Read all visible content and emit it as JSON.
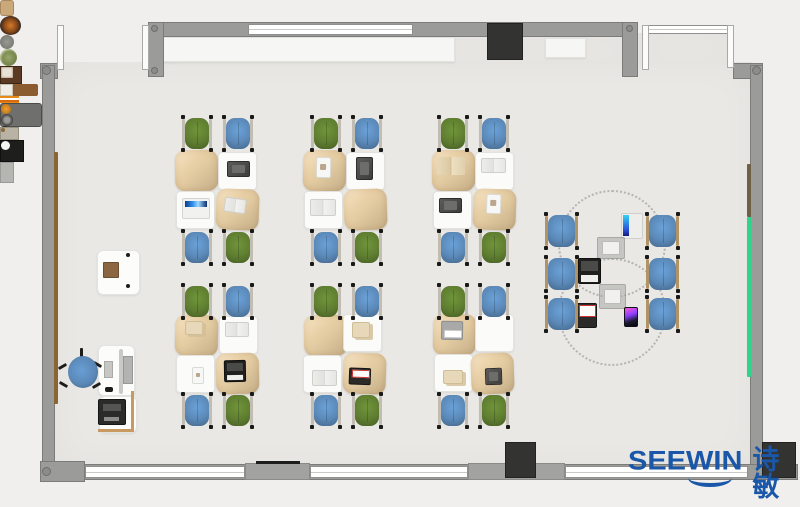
{
  "meta": {
    "description": "Top-down classroom / makerspace furniture floor plan render"
  },
  "logo": {
    "brand": "SEEWIN",
    "cjk": "诗敏",
    "color": "#1a57a8"
  },
  "palette": {
    "bg": "#f0efed",
    "floor": "#e9e8e5",
    "wall": "#9b9b99",
    "chair_green": "#5f7e31",
    "chair_blue": "#5b89b8",
    "desk_tan": "#e5cda4",
    "desk_white": "#fbfbf9",
    "frame_grey": "#c2bdb2",
    "frame_tan": "#b09465",
    "rail_brown_left": "#8a6432",
    "rail_brown_right": "#6f6148",
    "rail_green": "#2ed489",
    "dark_block": "#333332",
    "logo_blue": "#1a57a8"
  },
  "floorplan": {
    "floors": [
      {
        "x": 55,
        "y": 62,
        "w": 697,
        "h": 405
      },
      {
        "x": 163,
        "y": 35,
        "w": 474,
        "h": 30
      },
      {
        "x": 637,
        "y": 33,
        "w": 96,
        "h": 32
      }
    ],
    "walls": [
      {
        "x": 163,
        "y": 22,
        "w": 474,
        "h": 15
      },
      {
        "x": 40,
        "y": 63,
        "w": 18,
        "h": 16
      },
      {
        "x": 148,
        "y": 22,
        "w": 16,
        "h": 55
      },
      {
        "x": 622,
        "y": 22,
        "w": 16,
        "h": 55
      },
      {
        "x": 733,
        "y": 63,
        "w": 30,
        "h": 16
      },
      {
        "x": 42,
        "y": 65,
        "w": 13,
        "h": 412
      },
      {
        "x": 750,
        "y": 65,
        "w": 13,
        "h": 412
      },
      {
        "x": 40,
        "y": 464,
        "w": 758,
        "h": 16
      },
      {
        "x": 40,
        "y": 461,
        "w": 45,
        "h": 21
      }
    ],
    "piers": [
      {
        "x": 245,
        "y": 463,
        "w": 65,
        "h": 17
      },
      {
        "x": 468,
        "y": 463,
        "w": 97,
        "h": 17
      }
    ],
    "windows": [
      {
        "x": 248,
        "y": 24,
        "w": 165,
        "h": 11
      },
      {
        "x": 648,
        "y": 25,
        "w": 81,
        "h": 9
      },
      {
        "x": 85,
        "y": 466,
        "w": 160,
        "h": 12
      },
      {
        "x": 310,
        "y": 466,
        "w": 158,
        "h": 12
      },
      {
        "x": 565,
        "y": 466,
        "w": 183,
        "h": 12
      }
    ],
    "doors": [
      {
        "x": 57,
        "y": 25,
        "w": 7,
        "h": 45
      },
      {
        "x": 142,
        "y": 25,
        "w": 7,
        "h": 45
      },
      {
        "x": 642,
        "y": 25,
        "w": 7,
        "h": 45
      },
      {
        "x": 727,
        "y": 25,
        "w": 7,
        "h": 43
      }
    ],
    "dark_blocks": [
      {
        "x": 487,
        "y": 23,
        "w": 36,
        "h": 37,
        "name": "tv-screen"
      },
      {
        "x": 505,
        "y": 442,
        "w": 31,
        "h": 36,
        "name": "column-block"
      },
      {
        "x": 762,
        "y": 442,
        "w": 34,
        "h": 36,
        "name": "column-block"
      }
    ],
    "bench": {
      "x": 256,
      "y": 461,
      "w": 44,
      "h": 3
    },
    "rails": [
      {
        "x": 54,
        "y": 152,
        "w": 4,
        "h": 252,
        "color": "rail_brown_left",
        "name": "wall-rail-brown"
      },
      {
        "x": 747,
        "y": 164,
        "w": 4,
        "h": 53,
        "color": "rail_brown_right",
        "name": "wall-rail-brown"
      },
      {
        "x": 747,
        "y": 217,
        "w": 4,
        "h": 160,
        "color": "rail_green",
        "name": "whiteboard-rail-green"
      }
    ],
    "joints": [
      {
        "x": 42,
        "y": 66,
        "d": 9
      },
      {
        "x": 151,
        "y": 25,
        "d": 7
      },
      {
        "x": 151,
        "y": 67,
        "d": 7
      },
      {
        "x": 626,
        "y": 25,
        "d": 7
      },
      {
        "x": 752,
        "y": 66,
        "d": 9
      },
      {
        "x": 42,
        "y": 467,
        "d": 9
      }
    ],
    "shelves": [
      {
        "x": 163,
        "y": 37,
        "w": 292,
        "h": 25
      },
      {
        "x": 545,
        "y": 38,
        "w": 41,
        "h": 20
      }
    ],
    "shelf_items": [
      {
        "kind": "jar",
        "x": 163,
        "y": 45,
        "w": 12,
        "h": 14
      },
      {
        "kind": "bowl",
        "x": 179,
        "y": 42,
        "w": 21,
        "h": 19
      },
      {
        "kind": "pot",
        "x": 213,
        "y": 44,
        "w": 14,
        "h": 14
      },
      {
        "kind": "plant",
        "x": 252,
        "y": 42,
        "w": 17,
        "h": 17
      },
      {
        "kind": "photo",
        "x": 271,
        "y": 43,
        "w": 20,
        "h": 16
      },
      {
        "kind": "organizer",
        "x": 310,
        "y": 46,
        "w": 38,
        "h": 12
      },
      {
        "kind": "pencils",
        "x": 374,
        "y": 47,
        "w": 19,
        "h": 7
      },
      {
        "kind": "machine",
        "x": 403,
        "y": 38,
        "w": 40,
        "h": 22
      },
      {
        "kind": "smallbox",
        "x": 555,
        "y": 43,
        "w": 17,
        "h": 11
      },
      {
        "kind": "appliance",
        "x": 590,
        "y": 38,
        "w": 22,
        "h": 20
      },
      {
        "kind": "greybox",
        "x": 612,
        "y": 38,
        "w": 12,
        "h": 19
      }
    ],
    "pods": [
      {
        "chairs": [
          {
            "x": 182,
            "y": 117,
            "c": "green"
          },
          {
            "x": 223,
            "y": 117,
            "c": "blue"
          },
          {
            "x": 182,
            "y": 231,
            "c": "blue"
          },
          {
            "x": 223,
            "y": 231,
            "c": "green"
          }
        ],
        "desks": [
          {
            "x": 175,
            "y": 150,
            "k": "tan",
            "r": -1
          },
          {
            "x": 218,
            "y": 152,
            "k": "white",
            "p": {
              "k": "tablet",
              "x": 8,
              "y": 8,
              "w": 23,
              "h": 16
            }
          },
          {
            "x": 176,
            "y": 191,
            "k": "white",
            "p": {
              "k": "laptop-blue",
              "x": 5,
              "y": 6,
              "w": 28,
              "h": 21
            }
          },
          {
            "x": 216,
            "y": 189,
            "k": "tan",
            "r": 2,
            "p": {
              "k": "book",
              "x": 8,
              "y": 9,
              "w": 22,
              "h": 15,
              "r": 6
            }
          }
        ]
      },
      {
        "chairs": [
          {
            "x": 311,
            "y": 117,
            "c": "green"
          },
          {
            "x": 352,
            "y": 117,
            "c": "blue"
          },
          {
            "x": 311,
            "y": 231,
            "c": "blue"
          },
          {
            "x": 352,
            "y": 231,
            "c": "green"
          }
        ],
        "desks": [
          {
            "x": 303,
            "y": 150,
            "k": "tan",
            "r": 1,
            "p": {
              "k": "paper",
              "x": 13,
              "y": 7,
              "w": 15,
              "h": 21
            }
          },
          {
            "x": 346,
            "y": 152,
            "k": "white",
            "p": {
              "k": "tablet",
              "x": 9,
              "y": 4,
              "w": 17,
              "h": 23
            }
          },
          {
            "x": 304,
            "y": 191,
            "k": "white",
            "p": {
              "k": "book",
              "x": 5,
              "y": 7,
              "w": 26,
              "h": 17
            }
          },
          {
            "x": 344,
            "y": 189,
            "k": "tan",
            "r": -2
          }
        ]
      },
      {
        "chairs": [
          {
            "x": 438,
            "y": 117,
            "c": "green"
          },
          {
            "x": 479,
            "y": 117,
            "c": "blue"
          },
          {
            "x": 438,
            "y": 231,
            "c": "blue"
          },
          {
            "x": 479,
            "y": 231,
            "c": "green"
          }
        ],
        "desks": [
          {
            "x": 432,
            "y": 150,
            "k": "tan",
            "p": {
              "k": "book-tan",
              "x": 5,
              "y": 7,
              "w": 28,
              "h": 18
            }
          },
          {
            "x": 475,
            "y": 152,
            "k": "white",
            "p": {
              "k": "book",
              "x": 5,
              "y": 5,
              "w": 25,
              "h": 15
            }
          },
          {
            "x": 433,
            "y": 191,
            "k": "white",
            "p": {
              "k": "tablet",
              "x": 5,
              "y": 6,
              "w": 23,
              "h": 15
            }
          },
          {
            "x": 473,
            "y": 189,
            "k": "tan",
            "r": 2,
            "p": {
              "k": "paper",
              "x": 13,
              "y": 5,
              "w": 15,
              "h": 20
            }
          }
        ]
      },
      {
        "chairs": [
          {
            "x": 182,
            "y": 285,
            "c": "green"
          },
          {
            "x": 223,
            "y": 285,
            "c": "blue"
          },
          {
            "x": 182,
            "y": 394,
            "c": "blue"
          },
          {
            "x": 223,
            "y": 394,
            "c": "green"
          }
        ],
        "desks": [
          {
            "x": 175,
            "y": 315,
            "k": "tan",
            "r": 1,
            "p": {
              "k": "paper-tan",
              "x": 10,
              "y": 6,
              "w": 18,
              "h": 14
            }
          },
          {
            "x": 219,
            "y": 316,
            "k": "white",
            "p": {
              "k": "book",
              "x": 5,
              "y": 5,
              "w": 24,
              "h": 15
            }
          },
          {
            "x": 176,
            "y": 355,
            "k": "white",
            "p": {
              "k": "paper",
              "x": 15,
              "y": 11,
              "w": 12,
              "h": 17
            }
          },
          {
            "x": 216,
            "y": 353,
            "k": "tan",
            "r": -1,
            "p": {
              "k": "laptop-black",
              "x": 8,
              "y": 7,
              "w": 22,
              "h": 22
            }
          }
        ]
      },
      {
        "chairs": [
          {
            "x": 311,
            "y": 285,
            "c": "green"
          },
          {
            "x": 352,
            "y": 285,
            "c": "blue"
          },
          {
            "x": 311,
            "y": 394,
            "c": "blue"
          },
          {
            "x": 352,
            "y": 394,
            "c": "green"
          }
        ],
        "desks": [
          {
            "x": 304,
            "y": 315,
            "k": "tan",
            "r": -1
          },
          {
            "x": 343,
            "y": 314,
            "k": "white",
            "p": {
              "k": "paper-tan",
              "x": 8,
              "y": 7,
              "w": 18,
              "h": 16
            }
          },
          {
            "x": 303,
            "y": 355,
            "k": "white",
            "p": {
              "k": "book",
              "x": 8,
              "y": 14,
              "w": 25,
              "h": 16
            }
          },
          {
            "x": 343,
            "y": 353,
            "k": "tan",
            "r": 2,
            "p": {
              "k": "laptop-white",
              "x": 6,
              "y": 15,
              "w": 22,
              "h": 17
            }
          }
        ]
      },
      {
        "chairs": [
          {
            "x": 438,
            "y": 285,
            "c": "green"
          },
          {
            "x": 479,
            "y": 285,
            "c": "blue"
          },
          {
            "x": 438,
            "y": 394,
            "c": "blue"
          },
          {
            "x": 479,
            "y": 394,
            "c": "green"
          }
        ],
        "desks": [
          {
            "x": 433,
            "y": 314,
            "k": "tan",
            "r": 1,
            "p": {
              "k": "device-white",
              "x": 8,
              "y": 7,
              "w": 22,
              "h": 19
            }
          },
          {
            "x": 475,
            "y": 314,
            "k": "white"
          },
          {
            "x": 434,
            "y": 354,
            "k": "white",
            "p": {
              "k": "paper-tan",
              "x": 8,
              "y": 15,
              "w": 20,
              "h": 14
            }
          },
          {
            "x": 471,
            "y": 353,
            "k": "tan",
            "r": -2,
            "p": {
              "k": "tablet",
              "x": 14,
              "y": 15,
              "w": 17,
              "h": 17
            }
          }
        ]
      }
    ],
    "collab_zone": {
      "markings": [
        {
          "cx": 612,
          "cy": 244,
          "r": 54
        },
        {
          "cx": 612,
          "cy": 312,
          "r": 54
        }
      ],
      "chairs": [
        {
          "x": 545,
          "y": 214
        },
        {
          "x": 545,
          "y": 257
        },
        {
          "x": 545,
          "y": 297
        },
        {
          "x": 646,
          "y": 214
        },
        {
          "x": 646,
          "y": 257
        },
        {
          "x": 646,
          "y": 297
        }
      ],
      "devices": [
        {
          "kind": "stand-blue",
          "x": 621,
          "y": 213,
          "w": 22,
          "h": 26
        },
        {
          "kind": "pad-grey",
          "x": 597,
          "y": 237,
          "w": 28,
          "h": 22
        },
        {
          "kind": "laptop-black",
          "x": 578,
          "y": 258,
          "w": 23,
          "h": 26
        },
        {
          "kind": "pad-grey",
          "x": 599,
          "y": 284,
          "w": 27,
          "h": 25
        },
        {
          "kind": "laptop-white",
          "x": 576,
          "y": 303,
          "w": 21,
          "h": 25
        },
        {
          "kind": "phone",
          "x": 624,
          "y": 307,
          "w": 14,
          "h": 20
        }
      ]
    },
    "teacher": {
      "cabinet": {
        "x": 97,
        "y": 250,
        "w": 43,
        "h": 45
      },
      "cabinet_book": {
        "x": 103,
        "y": 262,
        "w": 16,
        "h": 16
      },
      "cabinet_dots": [
        {
          "x": 126,
          "y": 253
        },
        {
          "x": 126,
          "y": 284
        }
      ],
      "chair": {
        "x": 66,
        "y": 354,
        "w": 34,
        "h": 36
      },
      "desk": {
        "x": 98,
        "y": 345,
        "w": 37,
        "h": 51
      },
      "divider": {
        "x": 119,
        "y": 349,
        "w": 4,
        "h": 45
      },
      "monitor": {
        "x": 123,
        "y": 356,
        "w": 10,
        "h": 28
      },
      "keyboard": {
        "x": 104,
        "y": 361,
        "w": 9,
        "h": 17
      },
      "mouse": {
        "x": 105,
        "y": 387,
        "w": 8,
        "h": 5
      },
      "printer_desk": {
        "x": 99,
        "y": 396,
        "w": 38,
        "h": 37
      },
      "printer": {
        "x": 98,
        "y": 399,
        "w": 28,
        "h": 26
      },
      "trim_v": {
        "x": 131,
        "y": 391,
        "w": 3,
        "h": 41
      },
      "trim_h": {
        "x": 98,
        "y": 429,
        "w": 36,
        "h": 3
      }
    },
    "logo_pos": {
      "x": 628,
      "y": 447
    }
  }
}
